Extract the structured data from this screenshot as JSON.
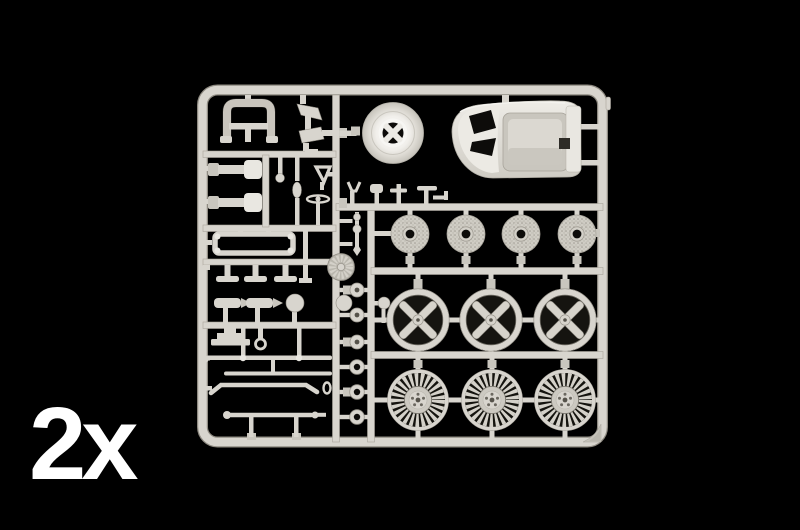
{
  "scene": {
    "description": "photo of an injection-molded model kit parts sprue on black background",
    "quantity_label": "2x",
    "colors": {
      "background": "#000000",
      "text": "#ffffff",
      "plastic": "#d8d5ce",
      "plastic_light": "#e9e7e1",
      "plastic_mid": "#c9c6be",
      "edge": "#a8a49b",
      "hole": "#0d0c0a"
    }
  },
  "sprue": {
    "parts": [
      {
        "name": "racing-bucket-seat",
        "count": 1
      },
      {
        "name": "dished-steering-wheel-disc",
        "count": 1
      },
      {
        "name": "roll-bar",
        "count": 1
      },
      {
        "name": "cross-drilled-brake-disc",
        "count": 4
      },
      {
        "name": "x-spoke-wheel-rim",
        "count": 3
      },
      {
        "name": "multi-spoke-fan-wheel-face",
        "count": 3
      },
      {
        "name": "wheel-hub-retainer",
        "count": 6
      },
      {
        "name": "shock-absorber",
        "count": 4
      },
      {
        "name": "suspension-rod",
        "count": 3
      },
      {
        "name": "sway-bar",
        "count": 1
      },
      {
        "name": "small-lever-and-linkage-parts",
        "count": 12
      }
    ]
  }
}
